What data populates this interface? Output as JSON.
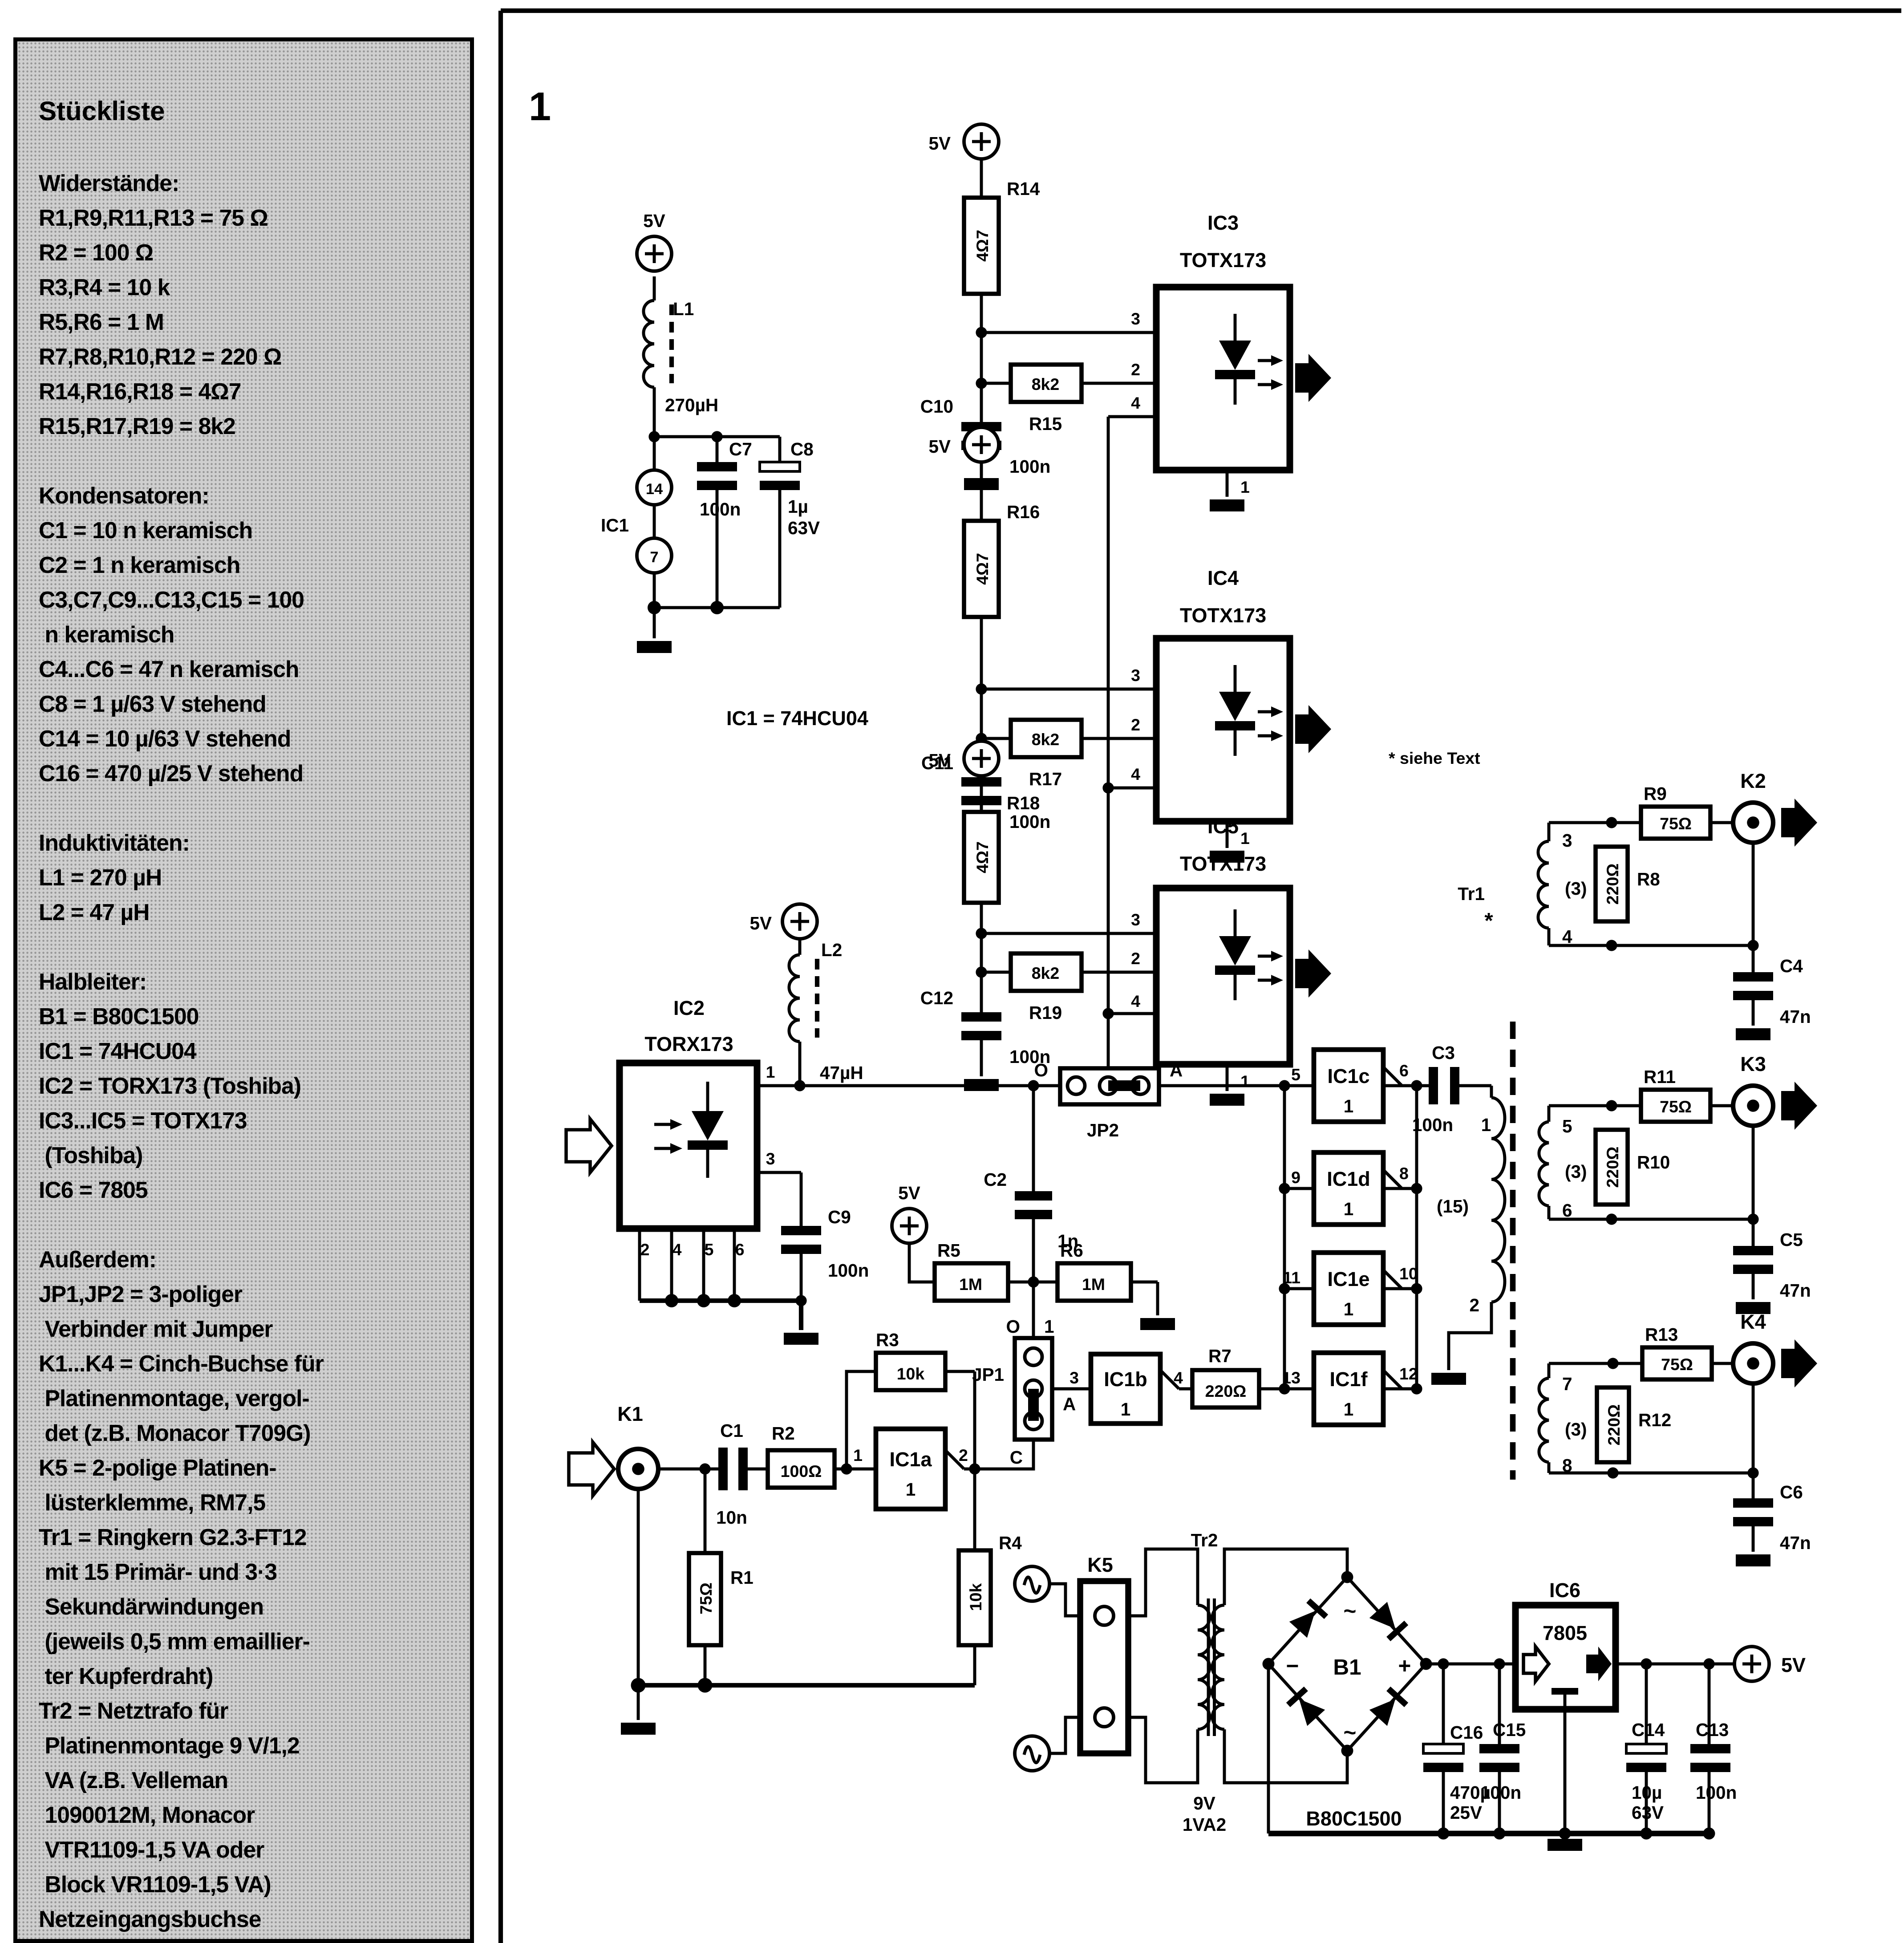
{
  "sidebar": {
    "title": "Stückliste",
    "lines": [
      "Widerstände:",
      "R1,R9,R11,R13 = 75 Ω",
      "R2 = 100 Ω",
      "R3,R4 = 10 k",
      "R5,R6 = 1 M",
      "R7,R8,R10,R12 = 220 Ω",
      "R14,R16,R18 = 4Ω7",
      "R15,R17,R19 = 8k2",
      "",
      "Kondensatoren:",
      "C1 = 10 n keramisch",
      "C2 = 1 n keramisch",
      "C3,C7,C9...C13,C15 = 100",
      " n keramisch",
      "C4...C6 = 47 n keramisch",
      "C8 = 1 µ/63 V stehend",
      "C14 = 10 µ/63 V stehend",
      "C16 = 470 µ/25 V stehend",
      "",
      "Induktivitäten:",
      "L1 = 270 µH",
      "L2 = 47 µH",
      "",
      "Halbleiter:",
      "B1 = B80C1500",
      "IC1 = 74HCU04",
      "IC2 = TORX173 (Toshiba)",
      "IC3...IC5 = TOTX173",
      " (Toshiba)",
      "IC6 = 7805",
      "",
      "Außerdem:",
      "JP1,JP2 = 3-poliger",
      " Verbinder mit Jumper",
      "K1...K4 = Cinch-Buchse für",
      " Platinenmontage, vergol-",
      " det (z.B. Monacor T709G)",
      "K5 = 2-polige Platinen-",
      " lüsterklemme, RM7,5",
      "Tr1 = Ringkern G2.3-FT12",
      " mit 15 Primär- und 3·3",
      " Sekundärwindungen",
      " (jeweils 0,5 mm emaillier-",
      " ter Kupferdraht)",
      "Tr2 = Netztrafo für",
      " Platinenmontage 9 V/1,2",
      " VA (z.B. Velleman",
      " 1090012M, Monacor",
      " VTR1109-1,5 VA oder",
      " Block VR1109-1,5 VA)",
      "Netzeingangsbuchse"
    ]
  },
  "t": {
    "fig": "1",
    "v5": "5V",
    "l1": "L1",
    "l1v": "270µH",
    "p14": "14",
    "ic1": "IC1",
    "p7": "7",
    "c7": "C7",
    "n100": "100n",
    "c8": "C8",
    "u1": "1µ",
    "v63": "63V",
    "ic1note": "IC1 = 74HCU04",
    "r14": "R14",
    "r16": "R16",
    "r18": "R18",
    "r47": "4Ω7",
    "k82": "8k2",
    "r15": "R15",
    "r17": "R17",
    "r19": "R19",
    "c10": "C10",
    "c11": "C11",
    "c12": "C12",
    "p1": "1",
    "p2": "2",
    "p3": "3",
    "p4": "4",
    "p5": "5",
    "p6": "6",
    "p8": "8",
    "p9": "9",
    "p10": "10",
    "p11": "11",
    "p12": "12",
    "p13": "13",
    "ic2": "IC2",
    "ic3": "IC3",
    "ic4": "IC4",
    "ic5": "IC5",
    "totx": "TOTX173",
    "torx": "TORX173",
    "siehe": "* siehe Text",
    "c9": "C9",
    "l2": "L2",
    "l2v": "47µH",
    "o": "O",
    "a": "A",
    "c": "C",
    "jp1": "JP1",
    "jp2": "JP2",
    "c2": "C2",
    "n1": "1n",
    "r5": "R5",
    "r6": "R6",
    "m1": "1M",
    "ic1a": "IC1a",
    "ic1b": "IC1b",
    "ic1c": "IC1c",
    "ic1d": "IC1d",
    "ic1e": "IC1e",
    "ic1f": "IC1f",
    "one": "1",
    "r7": "R7",
    "o220": "220Ω",
    "c3": "C3",
    "w15": "(15)",
    "w3": "(3)",
    "tr1": "Tr1",
    "star": "*",
    "r9": "R9",
    "r11": "R11",
    "r13": "R13",
    "o75": "75Ω",
    "r8": "R8",
    "r10": "R10",
    "r12": "R12",
    "k1": "K1",
    "k2": "K2",
    "k3": "K3",
    "k4": "K4",
    "c4": "C4",
    "c5": "C5",
    "c6": "C6",
    "n47": "47n",
    "c1": "C1",
    "n10": "10n",
    "r2": "R2",
    "o100": "100Ω",
    "r3": "R3",
    "k10": "10k",
    "r4": "R4",
    "r1": "R1",
    "k5": "K5",
    "tr2": "Tr2",
    "v9": "9V",
    "va12": "1VA2",
    "b1": "B1",
    "minus": "−",
    "plus": "+",
    "sine": "~",
    "b80": "B80C1500",
    "ic6": "IC6",
    "reg": "7805",
    "c16": "C16",
    "u470": "470µ",
    "v25": "25V",
    "c15": "C15",
    "c14": "C14",
    "u10": "10µ",
    "c13": "C13"
  }
}
